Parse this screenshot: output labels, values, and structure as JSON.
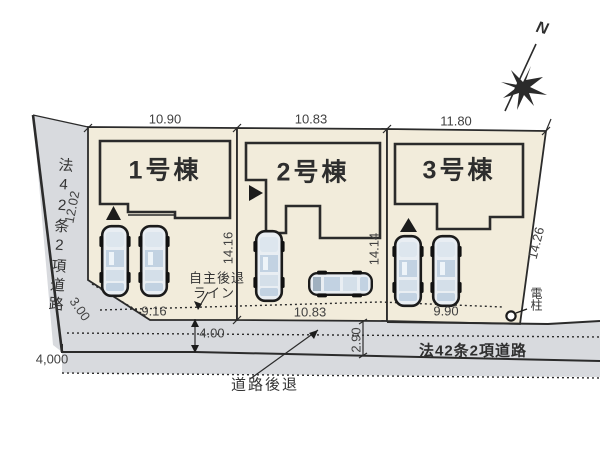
{
  "plan": {
    "north_label": "N",
    "roads": {
      "left": {
        "name": "法42条2項道路",
        "length_label": "12.02",
        "width_mm_label": "4,000"
      },
      "bottom": {
        "name": "法42条2項道路",
        "width_label": "4.00",
        "setback_depth_label": "2.90"
      }
    },
    "lots": [
      {
        "label": "1号棟",
        "frontage_top": "10.90",
        "frontage_bottom": "9.16",
        "depth": "14.16",
        "corner_cut": "3.00"
      },
      {
        "label": "2号棟",
        "frontage_top": "10.83",
        "frontage_bottom": "10.83",
        "depth": "14.14"
      },
      {
        "label": "3号棟",
        "frontage_top": "11.80",
        "frontage_bottom": "9.90",
        "depth": "14.26"
      }
    ],
    "annotations": {
      "voluntary_setback_line_1": "自主後退",
      "voluntary_setback_line_2": "ライン",
      "road_retreat": "道路後退",
      "utility_pole": "電柱"
    },
    "colors": {
      "lot_fill": "#f2ecdb",
      "road_fill": "#d8dade",
      "line": "#2b2b2b",
      "car_body": "#e9eef3",
      "car_glass": "#c2d2e2"
    }
  }
}
